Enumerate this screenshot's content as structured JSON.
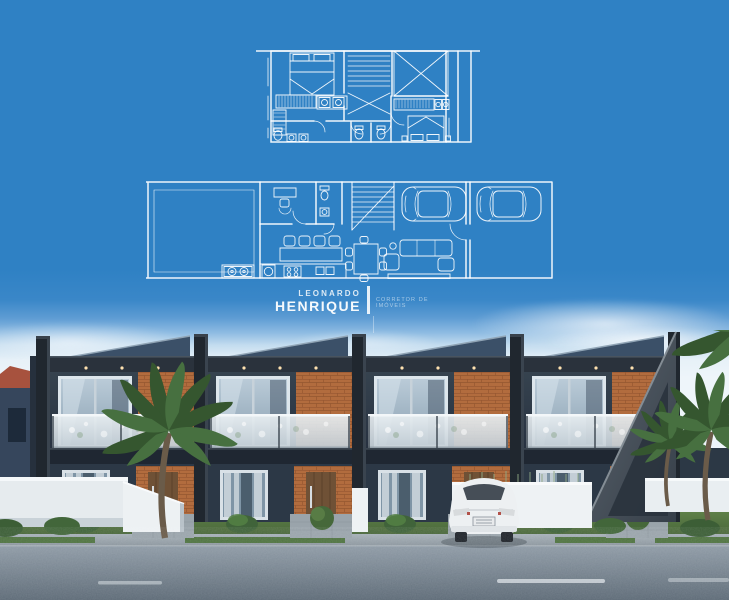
{
  "watermark": {
    "first_name": "LEONARDO",
    "last_name": "HENRIQUE",
    "tagline": "CORRETOR DE IMÓVEIS",
    "color": "#ffffff"
  },
  "palette": {
    "blueprint_blue": "#2f81c4",
    "blueprint_line": "#ffffff",
    "sky_horizon": "#e7f1f8",
    "facade_dark_navy": "#2c3846",
    "facade_charcoal": "#20272f",
    "brick_accent": "#b26c3e",
    "balcony_glass": "#dde6ec",
    "white_wall": "#eef2f4",
    "door_wood": "#6f5136",
    "lawn_green": "#567a44",
    "road_asphalt": "#7e8b96",
    "car_white": "#eef1f2",
    "palm_green": "#3a5d37",
    "neighbor_roof_red": "#a7523e"
  },
  "floorplans": {
    "upper_floor": {
      "name": "upper-floor-plan",
      "elements": [
        "double-bed-suite",
        "wardrobes",
        "staircase",
        "double-height-void",
        "closet-with-hangers",
        "two-bathrooms",
        "second-bedroom"
      ]
    },
    "ground_floor": {
      "name": "ground-floor-plan",
      "elements": [
        "backyard",
        "barbecue-counter",
        "laundry",
        "home-office-desk",
        "bathroom",
        "staircase",
        "kitchen-island-with-stools",
        "dining-table-six-chairs",
        "sofa-set-tv-bench",
        "two-parked-cars"
      ]
    }
  },
  "scene": {
    "building": "row of 4 two-story modern townhouses",
    "units_count": 4,
    "features": [
      "dark charcoal facades",
      "brick accent panels",
      "glass balcony railings",
      "recessed downlights",
      "diagonal concrete end wall"
    ],
    "vehicle": "white sedan parked in driveway",
    "vegetation": [
      "palm tree left",
      "palm trees right",
      "round topiary shrubs",
      "ornamental grasses"
    ],
    "road": {
      "surface": "asphalt",
      "marking": "white dashed center line"
    },
    "background": "neighboring house with red tile roof"
  }
}
